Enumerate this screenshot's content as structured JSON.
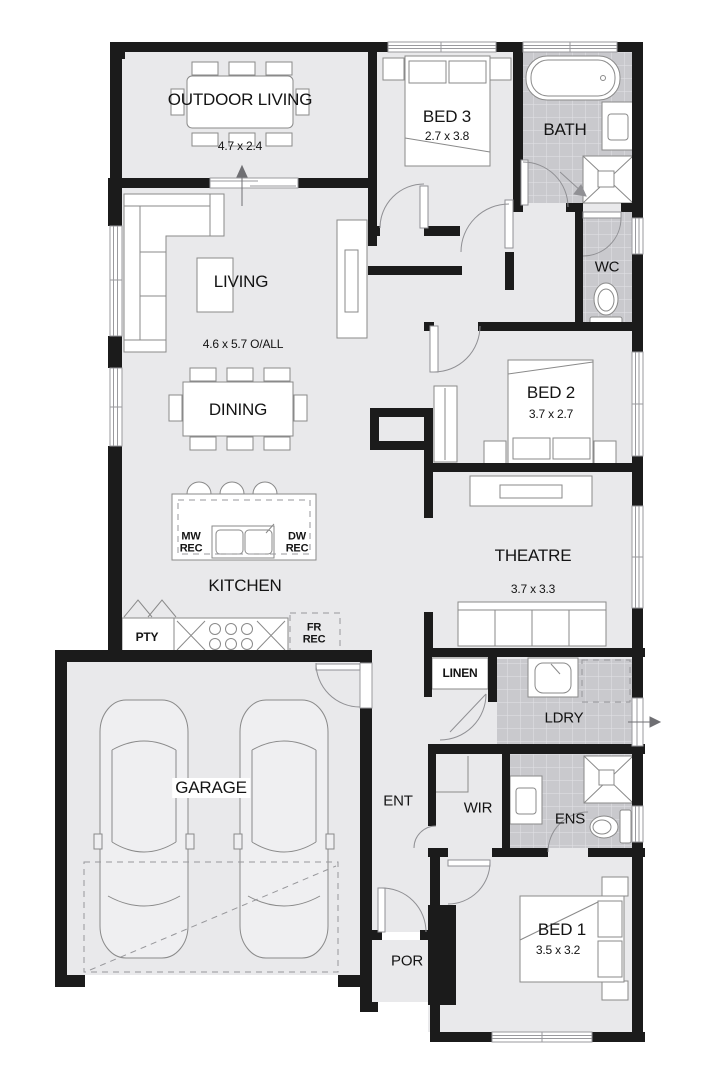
{
  "title": "Floor plan",
  "colors": {
    "floor": "#e9e9eb",
    "tile": "#c9c9cd",
    "wall": "#1b1b1b",
    "furniture_line": "#8a8a8a"
  },
  "rooms": {
    "outdoor_living": {
      "label": "OUTDOOR LIVING",
      "dim": "4.7 x 2.4"
    },
    "bed3": {
      "label": "BED 3",
      "dim": "2.7 x 3.8"
    },
    "bath": {
      "label": "BATH"
    },
    "living": {
      "label": "LIVING",
      "dim": "4.6 x 5.7 O/ALL"
    },
    "wc": {
      "label": "WC"
    },
    "dining": {
      "label": "DINING"
    },
    "bed2": {
      "label": "BED 2",
      "dim": "3.7 x 2.7"
    },
    "kitchen": {
      "label": "KITCHEN"
    },
    "theatre": {
      "label": "THEATRE",
      "dim": "3.7 x 3.3"
    },
    "pty": {
      "label": "PTY"
    },
    "linen": {
      "label": "LINEN"
    },
    "ldry": {
      "label": "LDRY"
    },
    "garage": {
      "label": "GARAGE"
    },
    "ent": {
      "label": "ENT"
    },
    "wir": {
      "label": "WIR"
    },
    "ens": {
      "label": "ENS"
    },
    "bed1": {
      "label": "BED 1",
      "dim": "3.5 x 3.2"
    },
    "por": {
      "label": "POR"
    }
  },
  "fixtures": {
    "mw_rec": {
      "line1": "MW",
      "line2": "REC"
    },
    "dw_rec": {
      "line1": "DW",
      "line2": "REC"
    },
    "fr_rec": {
      "line1": "FR",
      "line2": "REC"
    }
  }
}
